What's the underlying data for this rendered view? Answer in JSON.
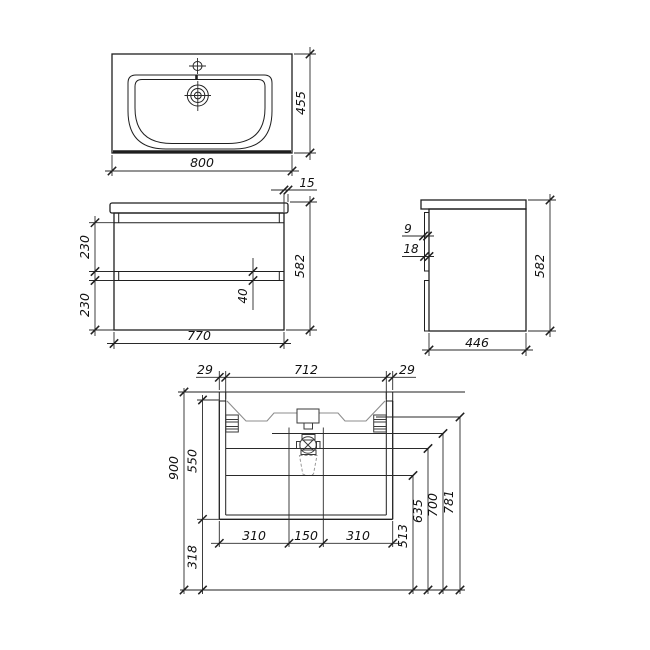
{
  "dims": {
    "top": {
      "width": "800",
      "depth": "455"
    },
    "front": {
      "width": "770",
      "height": "582",
      "overhang": "15",
      "upper_drawer": "230",
      "lower_drawer": "230",
      "drawer_gap": "40"
    },
    "side": {
      "depth": "446",
      "height": "582",
      "front_gap": "9",
      "front_thickness": "18"
    },
    "install": {
      "left_margin": "29",
      "inner_width": "712",
      "right_margin": "29",
      "total_height": "900",
      "cabinet_height": "550",
      "floor_clearance": "318",
      "span_left": "310",
      "span_center": "150",
      "span_right": "310",
      "h_siphon": "513",
      "h_valve": "635",
      "h_drain": "700",
      "h_bracket": "781"
    }
  }
}
